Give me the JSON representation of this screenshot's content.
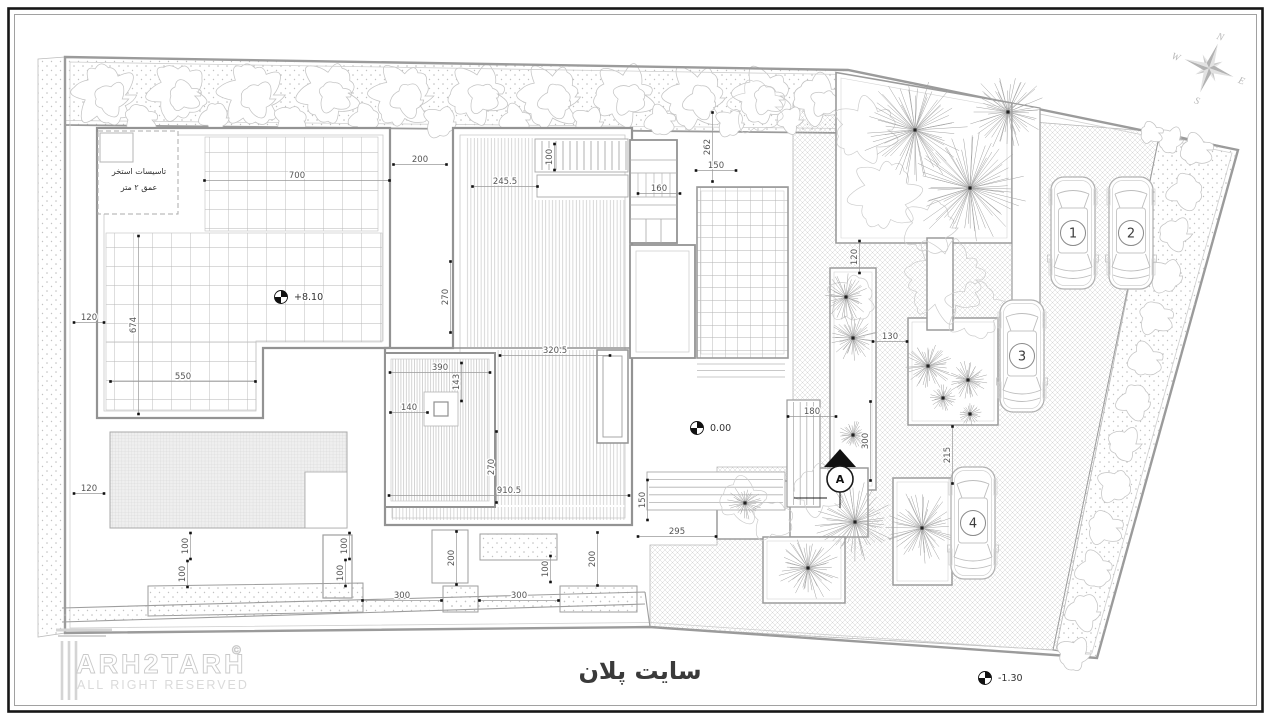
{
  "title": {
    "text": "سایت پلان"
  },
  "logo": {
    "name": "ARH2TARH",
    "copyright": "©",
    "tagline": "ALL RIGHT RESERVED"
  },
  "pool_note": {
    "line1": "تاسيسات استخر",
    "line2": "عمق ٢ متر"
  },
  "compass": {
    "north": "N",
    "east": "E",
    "south": "S",
    "west": "W"
  },
  "section_marker": {
    "label": "A"
  },
  "parking": {
    "cars": [
      {
        "number": "1"
      },
      {
        "number": "2"
      },
      {
        "number": "3"
      },
      {
        "number": "4"
      }
    ]
  },
  "elevation_markers": [
    {
      "label": "+8.10",
      "x": 281,
      "y": 297
    },
    {
      "label": "0.00",
      "x": 697,
      "y": 428
    },
    {
      "label": "-1.30",
      "x": 985,
      "y": 678
    }
  ],
  "dimensions": [
    {
      "text": "700",
      "x": 297,
      "y": 176,
      "orient": "h",
      "len": 185
    },
    {
      "text": "200",
      "x": 420,
      "y": 160,
      "orient": "h",
      "len": 53
    },
    {
      "text": "245.5",
      "x": 505,
      "y": 182,
      "orient": "h",
      "len": 65
    },
    {
      "text": "100",
      "x": 550,
      "y": 157,
      "orient": "v",
      "len": 26
    },
    {
      "text": "160",
      "x": 659,
      "y": 189,
      "orient": "h",
      "len": 42
    },
    {
      "text": "262",
      "x": 708,
      "y": 147,
      "orient": "v",
      "len": 69
    },
    {
      "text": "150",
      "x": 716,
      "y": 166,
      "orient": "h",
      "len": 40
    },
    {
      "text": "120",
      "x": 855,
      "y": 257,
      "orient": "v",
      "len": 32
    },
    {
      "text": "130",
      "x": 890,
      "y": 337,
      "orient": "h",
      "len": 34
    },
    {
      "text": "120",
      "x": 89,
      "y": 318,
      "orient": "h",
      "len": 30
    },
    {
      "text": "674",
      "x": 134,
      "y": 325,
      "orient": "v",
      "len": 178
    },
    {
      "text": "550",
      "x": 183,
      "y": 377,
      "orient": "h",
      "len": 145
    },
    {
      "text": "270",
      "x": 446,
      "y": 297,
      "orient": "v",
      "len": 71
    },
    {
      "text": "320.5",
      "x": 555,
      "y": 351,
      "orient": "h",
      "len": 110
    },
    {
      "text": "390",
      "x": 440,
      "y": 368,
      "orient": "h",
      "len": 100
    },
    {
      "text": "143",
      "x": 457,
      "y": 382,
      "orient": "v",
      "len": 38
    },
    {
      "text": "140",
      "x": 409,
      "y": 408,
      "orient": "h",
      "len": 37
    },
    {
      "text": "270",
      "x": 492,
      "y": 467,
      "orient": "v",
      "len": 71
    },
    {
      "text": "910.5",
      "x": 509,
      "y": 491,
      "orient": "h",
      "len": 240
    },
    {
      "text": "180",
      "x": 812,
      "y": 412,
      "orient": "h",
      "len": 48
    },
    {
      "text": "300",
      "x": 866,
      "y": 441,
      "orient": "v",
      "len": 79
    },
    {
      "text": "215",
      "x": 948,
      "y": 455,
      "orient": "v",
      "len": 57
    },
    {
      "text": "150",
      "x": 643,
      "y": 500,
      "orient": "v",
      "len": 40
    },
    {
      "text": "295",
      "x": 677,
      "y": 532,
      "orient": "h",
      "len": 78
    },
    {
      "text": "120",
      "x": 89,
      "y": 489,
      "orient": "h",
      "len": 30
    },
    {
      "text": "100",
      "x": 186,
      "y": 546,
      "orient": "v",
      "len": 26
    },
    {
      "text": "100",
      "x": 183,
      "y": 574,
      "orient": "v",
      "len": 26
    },
    {
      "text": "100",
      "x": 345,
      "y": 546,
      "orient": "v",
      "len": 26
    },
    {
      "text": "100",
      "x": 341,
      "y": 573,
      "orient": "v",
      "len": 26
    },
    {
      "text": "200",
      "x": 452,
      "y": 558,
      "orient": "v",
      "len": 53
    },
    {
      "text": "100",
      "x": 546,
      "y": 569,
      "orient": "v",
      "len": 26
    },
    {
      "text": "200",
      "x": 593,
      "y": 559,
      "orient": "v",
      "len": 53
    },
    {
      "text": "300",
      "x": 402,
      "y": 596,
      "orient": "h",
      "len": 79
    },
    {
      "text": "300",
      "x": 519,
      "y": 596,
      "orient": "h",
      "len": 79
    }
  ],
  "colors": {
    "paper": "#ffffff",
    "frame": "#161616",
    "wall": "#939393",
    "light_line": "#c9c9c9",
    "dim_text": "#555555",
    "hatch": "#cfcfcf"
  }
}
